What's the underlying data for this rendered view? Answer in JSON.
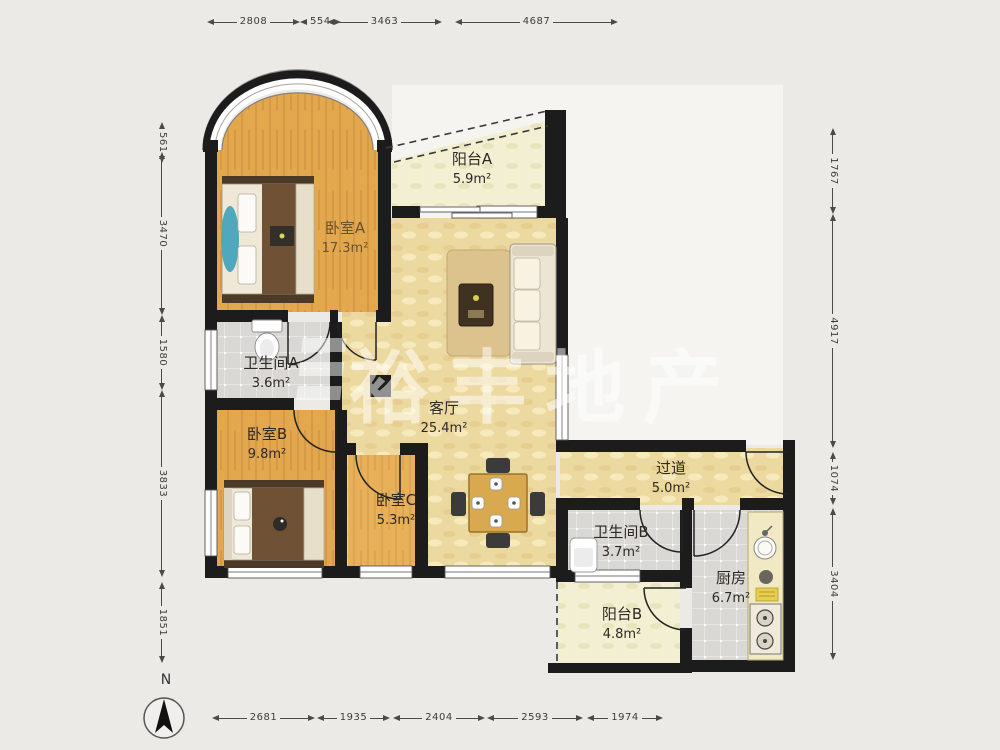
{
  "plan": {
    "rooms": [
      {
        "id": "balcony-a",
        "name": "阳台A",
        "area": "5.9m²"
      },
      {
        "id": "bedroom-a",
        "name": "卧室A",
        "area": "17.3m²"
      },
      {
        "id": "bathroom-a",
        "name": "卫生间A",
        "area": "3.6m²"
      },
      {
        "id": "bedroom-b",
        "name": "卧室B",
        "area": "9.8m²"
      },
      {
        "id": "living-room",
        "name": "客厅",
        "area": "25.4m²"
      },
      {
        "id": "bedroom-c",
        "name": "卧室C",
        "area": "5.3m²"
      },
      {
        "id": "hallway",
        "name": "过道",
        "area": "5.0m²"
      },
      {
        "id": "bathroom-b",
        "name": "卫生间B",
        "area": "3.7m²"
      },
      {
        "id": "kitchen",
        "name": "厨房",
        "area": "6.7m²"
      },
      {
        "id": "balcony-b",
        "name": "阳台B",
        "area": "4.8m²"
      }
    ],
    "dimensions": {
      "top": [
        "2808",
        "554",
        "3463",
        "4687"
      ],
      "bottom": [
        "2681",
        "1935",
        "2404",
        "2593",
        "1974"
      ],
      "left": [
        "561",
        "3470",
        "1580",
        "3833",
        "1851"
      ],
      "right": [
        "1767",
        "4917",
        "1074",
        "3404"
      ]
    },
    "compass": {
      "label": "N"
    },
    "watermark": {
      "text": "裕丰地产"
    }
  }
}
